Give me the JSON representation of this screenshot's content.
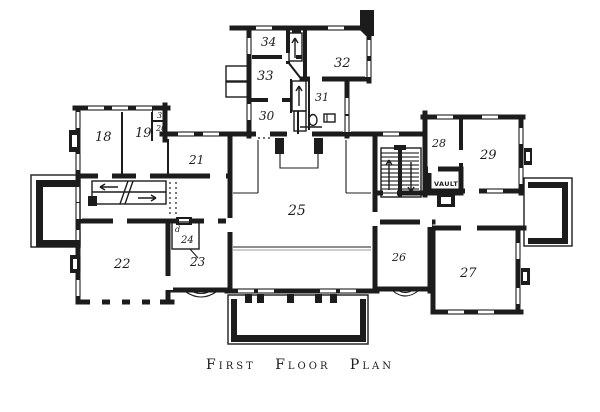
{
  "colors": {
    "ink": "#1c1c1c",
    "paper": "#ffffff"
  },
  "caption": "First Floor Plan",
  "labels": {
    "room18": "18",
    "room19": "19",
    "room21": "21",
    "room22": "22",
    "room23": "23",
    "room24": "24",
    "room25": "25",
    "room26": "26",
    "room27": "27",
    "room28": "28",
    "room29": "29",
    "room30": "30",
    "room31": "31",
    "room32": "32",
    "room33": "33",
    "room34": "34",
    "closet_upper": "30",
    "closet_lower": "20",
    "door_mark": "d",
    "vault": "VAULT"
  }
}
